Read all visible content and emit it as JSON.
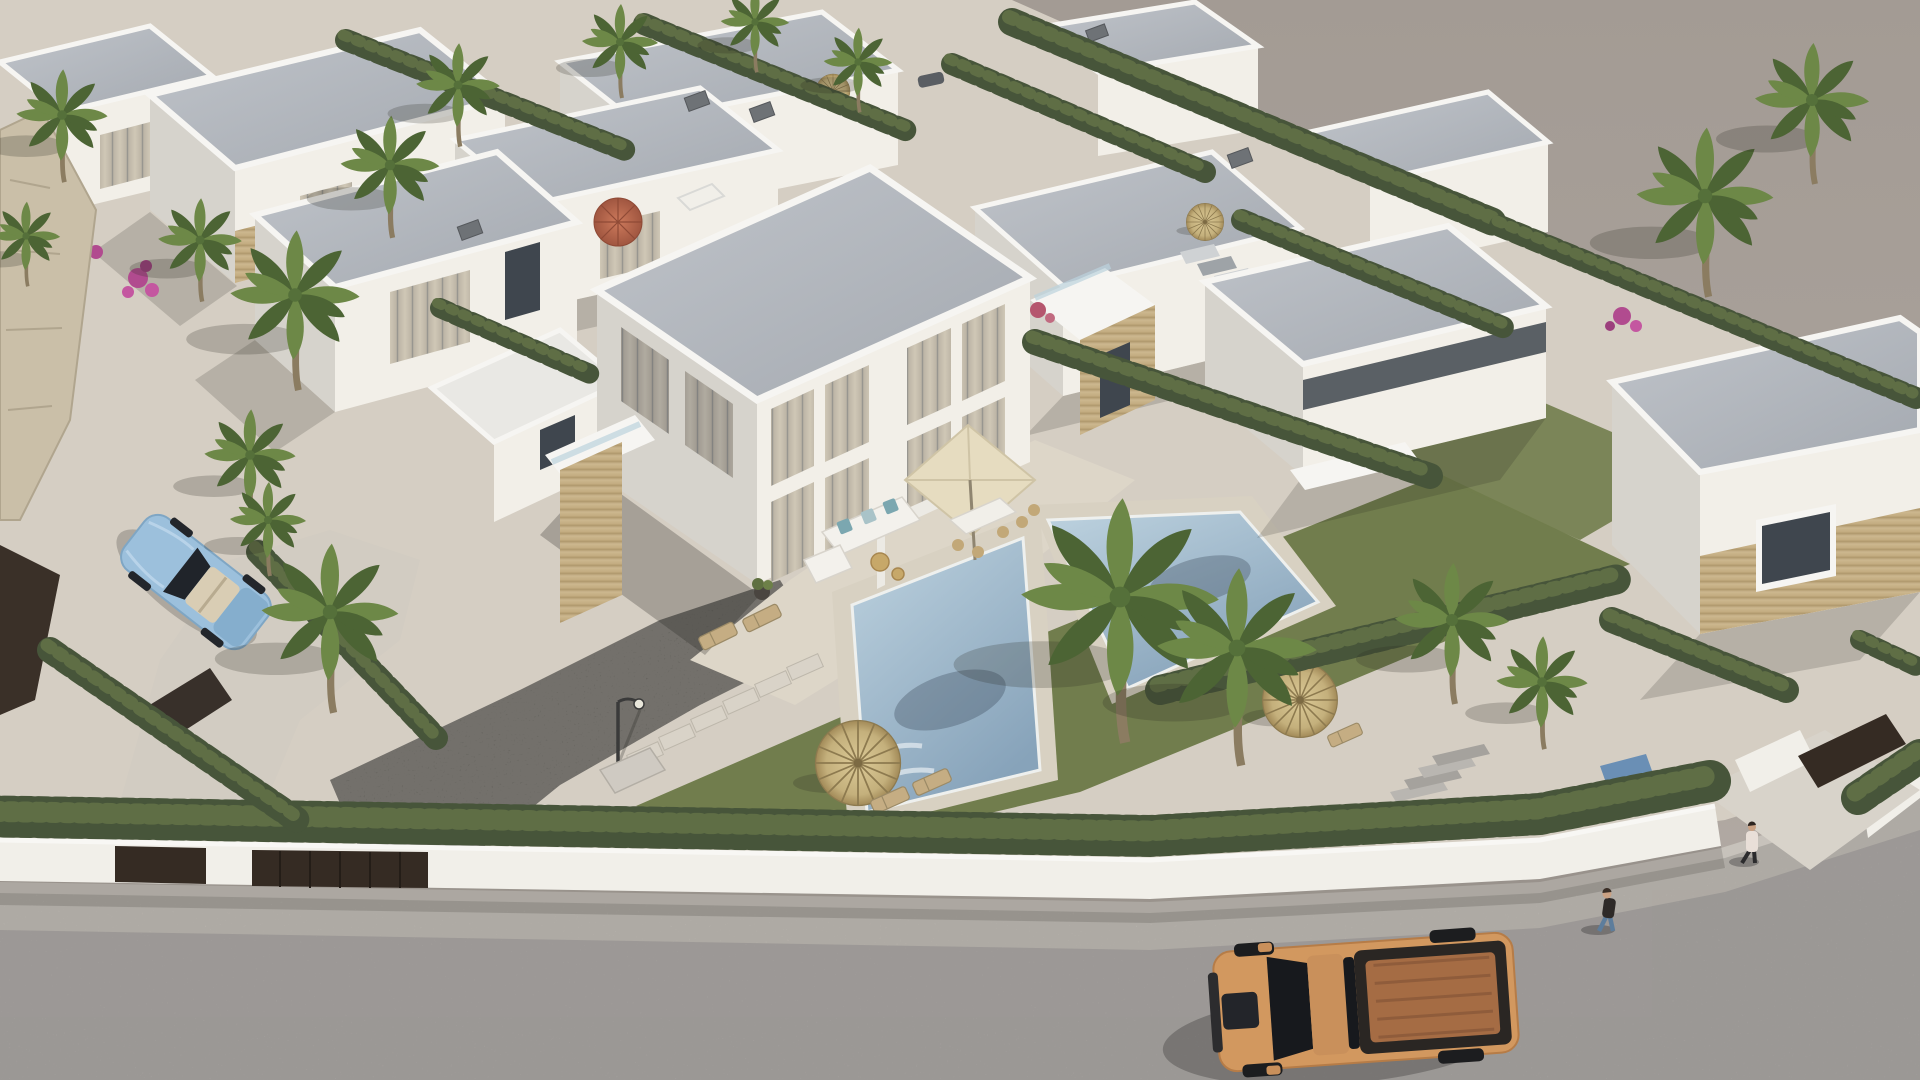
{
  "scene": {
    "title": "Aerial 3D architectural render of a modern white villa development with private pools, palm trees, hedged gardens and a street with vehicles",
    "type": "aerial-architectural-render",
    "time_of_day": "late afternoon, long soft shadows toward lower-left",
    "no_visible_text": true,
    "objects": {
      "buildings": "white flat-roof duplex villas with beige stone cladding accents and curtained floor-to-ceiling windows",
      "center_villa": "two-storey duplex with terrace, cream square patio umbrella, white corner sofa with blue cushions, rattan dining chairs",
      "pools": "two rectangular light-blue mosaic pools with travertine decks",
      "vegetation": "cypress hedges, fan palms, banana plants, pink bougainvillea, olive-green lawns",
      "street": "light gray concrete street along the bottom with white perimeter walls and dark entrance gates",
      "vehicles": [
        "orange pickup truck on street",
        "light blue convertible on driveway",
        "small blue-red play equipment behind hedge"
      ],
      "people": [
        "pedestrian in dark top and jeans",
        "pedestrian in light coat near right gate"
      ],
      "furniture": [
        "thatched straw parasols with sun loungers",
        "terracotta-red umbrella in upper garden",
        "street lamp",
        "outdoor shower",
        "stepping stones",
        "roof-access stairs"
      ]
    }
  },
  "palette": {
    "ground": "#a8a099",
    "groundLight": "#b4aca5",
    "sand": "#d5cec3",
    "street": "#b2aeab",
    "sidewalk": "#c7c2bb",
    "wallWhite": "#f1efe9",
    "wallShade": "#dbd8d2",
    "trim": "#f6f5f2",
    "roofA": "#bcc0c6",
    "roofB": "#a7acb3",
    "facade": "#f2efe8",
    "facadeShade": "#d6d3cc",
    "stoneA": "#ccb78f",
    "stoneB": "#b29b70",
    "glass": "#3f464e",
    "curtainA": "#cfc7b6",
    "curtainB": "#8e8e8a",
    "hedge": "#47553a",
    "hedgeLight": "#5f6e45",
    "lawn": "#717d4d",
    "gravel": "#504d49",
    "poolDeck": "#d8d1c2",
    "waterA": "#bdd2df",
    "waterB": "#87a3ba",
    "thatchA": "#d8c795",
    "thatchB": "#ab9362",
    "red": "#bb6a50",
    "gate": "#352b23",
    "truck": "#d2985f",
    "truckDark": "#1e2023",
    "truckBed": "#a56c44",
    "car": "#9cc0dc",
    "skin": "#caa183",
    "trunk": "#8b7c61",
    "palmA": "#6d8847",
    "palmB": "#4c6434"
  },
  "palms": [
    {
      "x": 295,
      "y": 295,
      "s": 1.7
    },
    {
      "x": 250,
      "y": 455,
      "s": 1.2
    },
    {
      "x": 390,
      "y": 165,
      "s": 1.3
    },
    {
      "x": 458,
      "y": 85,
      "s": 1.1
    },
    {
      "x": 330,
      "y": 612,
      "s": 1.8
    },
    {
      "x": 268,
      "y": 520,
      "s": 1.0
    },
    {
      "x": 620,
      "y": 42,
      "s": 1.0
    },
    {
      "x": 858,
      "y": 62,
      "s": 0.9
    },
    {
      "x": 755,
      "y": 22,
      "s": 0.9
    },
    {
      "x": 1120,
      "y": 597,
      "s": 2.6
    },
    {
      "x": 1237,
      "y": 648,
      "s": 2.1
    },
    {
      "x": 1452,
      "y": 620,
      "s": 1.5
    },
    {
      "x": 1542,
      "y": 682,
      "s": 1.2
    },
    {
      "x": 1705,
      "y": 196,
      "s": 1.8
    },
    {
      "x": 1812,
      "y": 100,
      "s": 1.5
    },
    {
      "x": 62,
      "y": 115,
      "s": 1.2
    },
    {
      "x": 26,
      "y": 236,
      "s": 0.9
    },
    {
      "x": 200,
      "y": 240,
      "s": 1.1
    }
  ],
  "hedgerows": [
    {
      "pts": [
        [
          -30,
          816
        ],
        [
          1150,
          836
        ],
        [
          1540,
          814
        ],
        [
          1715,
          780
        ]
      ],
      "w": 42
    },
    {
      "pts": [
        [
          1858,
          798
        ],
        [
          1920,
          756
        ]
      ],
      "w": 34
    },
    {
      "pts": [
        [
          1160,
          690
        ],
        [
          1622,
          578
        ]
      ],
      "w": 30
    },
    {
      "pts": [
        [
          1035,
          342
        ],
        [
          1430,
          476
        ]
      ],
      "w": 26
    },
    {
      "pts": [
        [
          1012,
          22
        ],
        [
          1498,
          224
        ]
      ],
      "w": 28
    },
    {
      "pts": [
        [
          1500,
          226
        ],
        [
          1916,
          398
        ]
      ],
      "w": 22
    },
    {
      "pts": [
        [
          346,
          40
        ],
        [
          630,
          152
        ]
      ],
      "w": 22
    },
    {
      "pts": [
        [
          644,
          24
        ],
        [
          910,
          132
        ]
      ],
      "w": 22
    },
    {
      "pts": [
        [
          952,
          64
        ],
        [
          1205,
          172
        ]
      ],
      "w": 22
    },
    {
      "pts": [
        [
          1242,
          220
        ],
        [
          1505,
          328
        ]
      ],
      "w": 22
    },
    {
      "pts": [
        [
          440,
          308
        ],
        [
          590,
          374
        ]
      ],
      "w": 20
    },
    {
      "pts": [
        [
          258,
          552
        ],
        [
          436,
          738
        ]
      ],
      "w": 24
    },
    {
      "pts": [
        [
          50,
          650
        ],
        [
          300,
          822
        ]
      ],
      "w": 26
    },
    {
      "pts": [
        [
          1612,
          620
        ],
        [
          1786,
          690
        ]
      ],
      "w": 26
    },
    {
      "pts": [
        [
          1860,
          640
        ],
        [
          1920,
          668
        ]
      ],
      "w": 20
    }
  ]
}
